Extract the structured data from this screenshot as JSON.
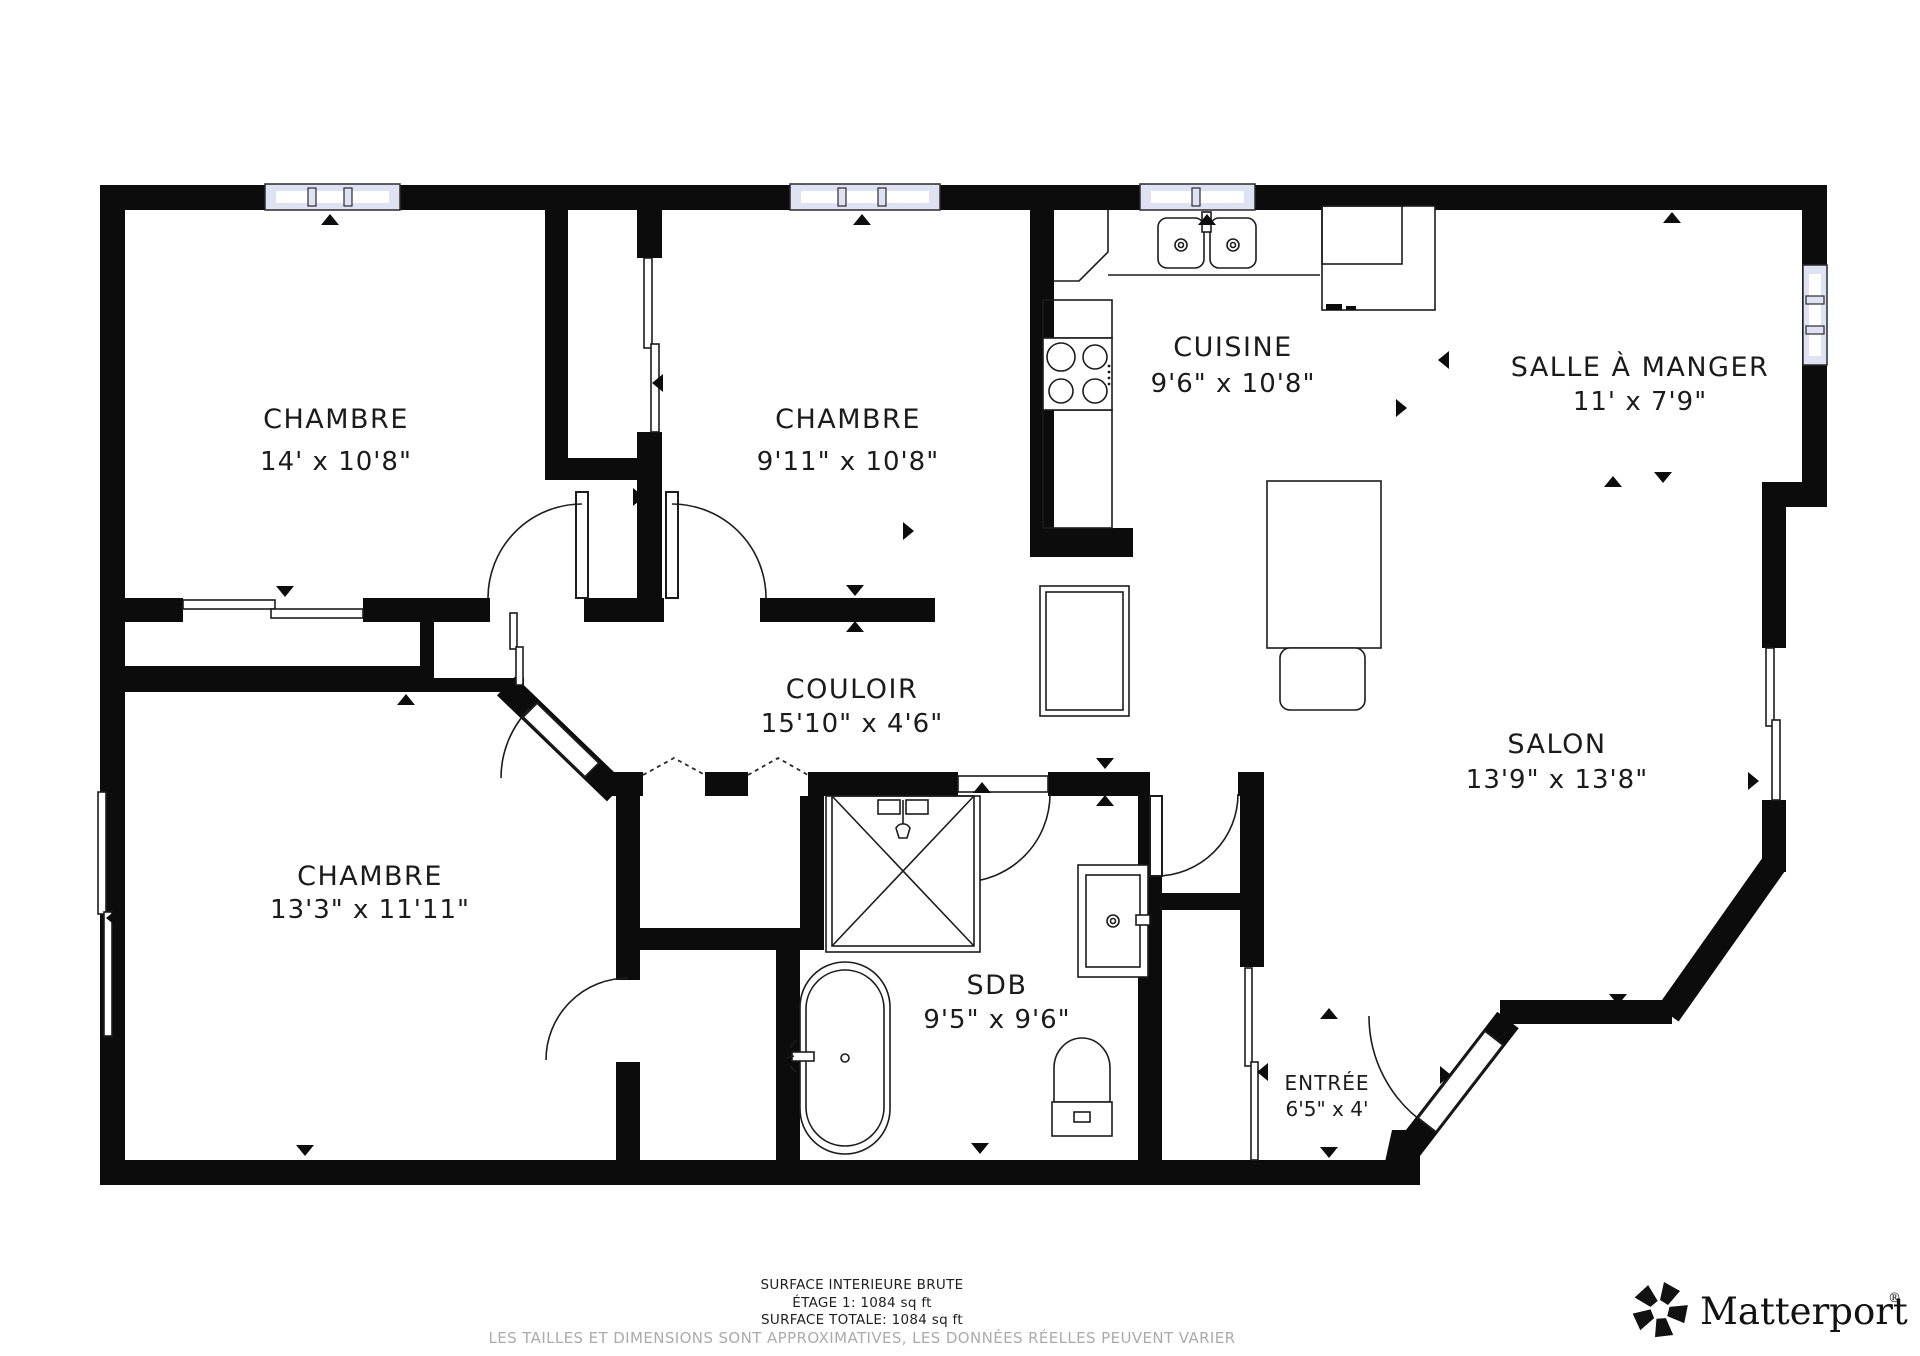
{
  "plan": {
    "rooms": [
      {
        "id": "bedroom-1",
        "name": "CHAMBRE",
        "dims": "14' x 10'8\""
      },
      {
        "id": "bedroom-2",
        "name": "CHAMBRE",
        "dims": "9'11\" x 10'8\""
      },
      {
        "id": "kitchen",
        "name": "CUISINE",
        "dims": "9'6\" x 10'8\""
      },
      {
        "id": "dining-room",
        "name": "SALLE À MANGER",
        "dims": "11' x 7'9\""
      },
      {
        "id": "hallway",
        "name": "COULOIR",
        "dims": "15'10\" x 4'6\""
      },
      {
        "id": "living-room",
        "name": "SALON",
        "dims": "13'9\" x 13'8\""
      },
      {
        "id": "bedroom-3",
        "name": "CHAMBRE",
        "dims": "13'3\" x 11'11\""
      },
      {
        "id": "bathroom",
        "name": "SDB",
        "dims": "9'5\" x 9'6\""
      },
      {
        "id": "entry",
        "name": "ENTRÉE",
        "dims": "6'5\" x 4'"
      }
    ],
    "fixtures": [
      "double-sink",
      "stove",
      "refrigerator",
      "island-table",
      "chair",
      "shower",
      "bathtub",
      "vanity-sink",
      "toilet"
    ]
  },
  "footer": {
    "line1": "SURFACE INTERIEURE BRUTE",
    "line2": "ÉTAGE 1: 1084 sq ft",
    "line3": "SURFACE TOTALE: 1084 sq ft",
    "note": "LES TAILLES ET DIMENSIONS SONT APPROXIMATIVES, LES DONNÉES RÉELLES PEUVENT VARIER"
  },
  "brand": {
    "name": "Matterport",
    "registered": "®"
  },
  "colors": {
    "wall": "#0c0c0c",
    "window": "#dfe2f3",
    "text": "#1b1b1b",
    "note": "#ababab"
  }
}
